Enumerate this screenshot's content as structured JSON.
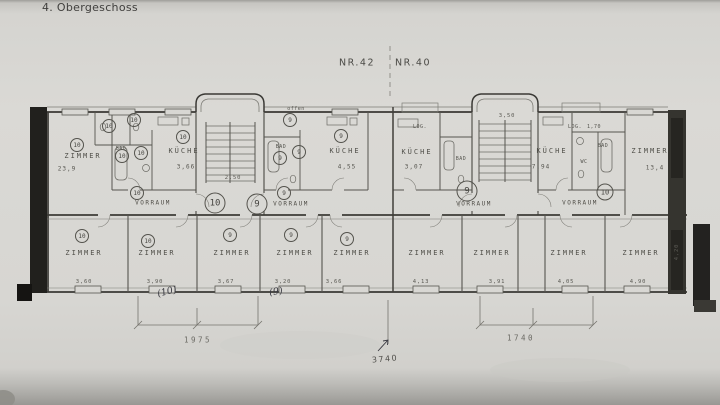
{
  "header": {
    "title": "4. Obergeschoss"
  },
  "buildings": {
    "left": "NR.42",
    "right": "NR.40"
  },
  "floorplan": {
    "rooms": {
      "zimmer_left": {
        "label": "ZIMMER",
        "area": "23,9"
      },
      "bad_10_left": {
        "label": "BAD"
      },
      "kueche_10_left": {
        "label": "KÜCHE",
        "area": "3,66"
      },
      "vorraum_10_left": {
        "label": "VORRAUM"
      },
      "bad_9_left": {
        "label": "BAD"
      },
      "kueche_9_left": {
        "label": "KÜCHE",
        "area": "4,55"
      },
      "vorraum_9_left": {
        "label": "VORRAUM"
      },
      "loggia_left": {
        "label": "LOG."
      },
      "kueche_9_right": {
        "label": "KÜCHE",
        "area": "3,07"
      },
      "bad_9_right": {
        "label": "BAD"
      },
      "vorraum_9_right": {
        "label": "VORRAUM"
      },
      "loggia_right": {
        "label": "LOG.",
        "dim": "1,70"
      },
      "kueche_10_right": {
        "label": "KÜCHE",
        "area": "7,94"
      },
      "bad_10_right": {
        "label": "BAD"
      },
      "wc_10_right": {
        "label": "WC"
      },
      "zimmer_10_right": {
        "label": "ZIMMER",
        "area": "13,4"
      },
      "vorraum_10_right": {
        "label": "VORRAUM"
      }
    },
    "bottom_rooms": [
      {
        "label": "ZIMMER",
        "apartment": "10",
        "width": "3,60"
      },
      {
        "label": "ZIMMER",
        "apartment": "10",
        "width": "3,90"
      },
      {
        "label": "ZIMMER",
        "apartment": "9",
        "width": "3,67"
      },
      {
        "label": "ZIMMER",
        "apartment": "9",
        "width": "3,20"
      },
      {
        "label": "ZIMMER",
        "apartment": "9",
        "width": "3,66"
      },
      {
        "label": "ZIMMER",
        "width": "4,13"
      },
      {
        "label": "ZIMMER",
        "width": "3,91"
      },
      {
        "label": "ZIMMER",
        "width": "4,05"
      },
      {
        "label": "ZIMMER",
        "width": "4,90"
      }
    ],
    "marks": {
      "entrance_10_left": "10",
      "entrance_9_left": "9",
      "entrance_9_right": "9",
      "entrance_10_right": "10",
      "zimmer_left": "10",
      "wc_left_a": "10",
      "wc_left_b": "10",
      "bad_left_a": "10",
      "bad_left_b": "10",
      "kueche_10_left": "10",
      "vorraum_10_left": "10",
      "top_9": "9",
      "bad_9_a": "9",
      "bad_9_b": "9",
      "kueche_9_left": "9",
      "vorraum_9_left": "9"
    },
    "dimensions": {
      "stair_left": "2,50",
      "stair_right": "3,50",
      "open_label": "offen",
      "left_total": "1975",
      "right_total": "1740",
      "overall": "3740",
      "right_vertical": "4,20"
    },
    "annotations": {
      "apartment_10": "(10)",
      "apartment_9": "(9)"
    }
  },
  "colors": {
    "paper": "#d8d7d3",
    "ink_lines": "#56554f",
    "dark_wall": "#21201d",
    "handwriting": "#3a3a42"
  }
}
